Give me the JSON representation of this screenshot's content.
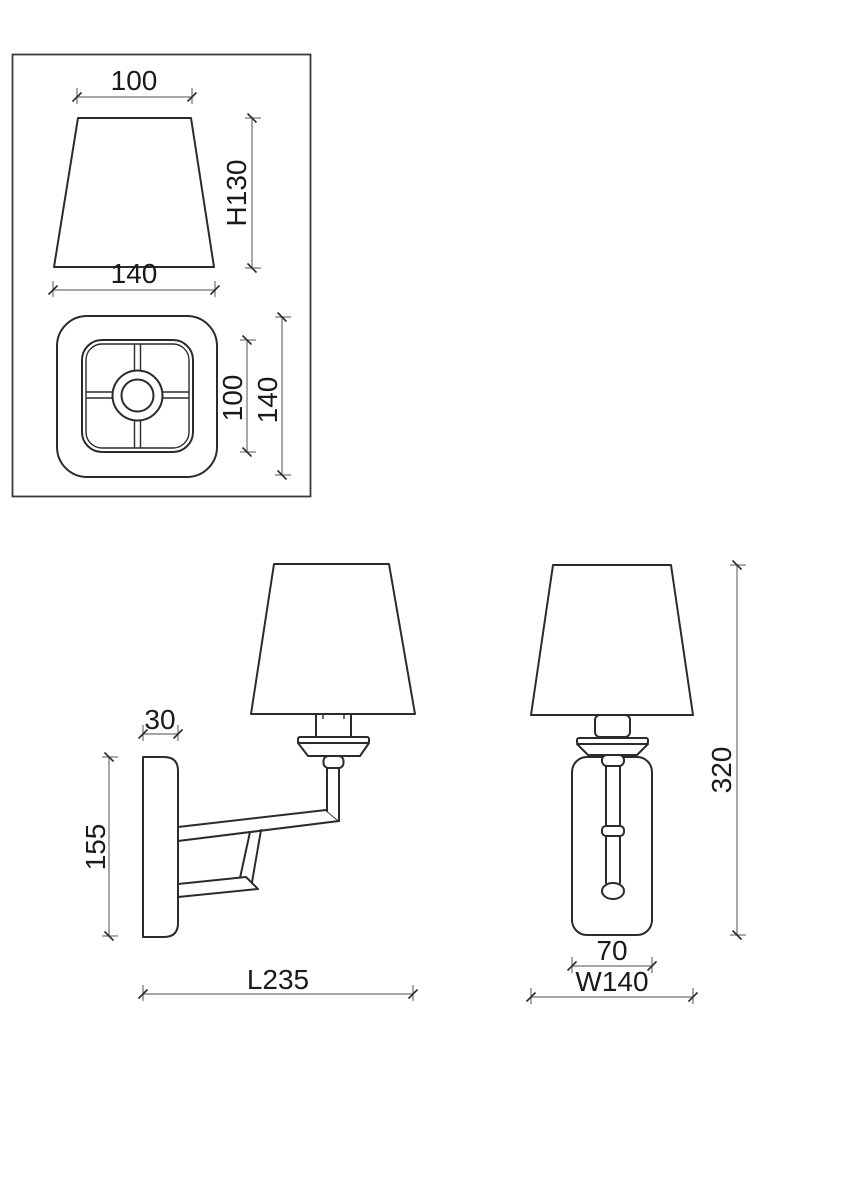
{
  "inset": {
    "shade_side_view": {
      "top_width_label": "100",
      "bottom_width_label": "140",
      "height_label": "H130"
    },
    "shade_top_view": {
      "inner_width_label": "100",
      "outer_width_label": "140"
    }
  },
  "side_view": {
    "plate_depth_label": "30",
    "plate_height_label": "155",
    "length_label": "L235"
  },
  "front_view": {
    "overall_height_label": "320",
    "plate_width_label": "70",
    "shade_width_label": "W140"
  },
  "colors": {
    "outline": "#2b2b2b",
    "dimension_line": "#707070",
    "label_text": "#1a1a1a",
    "background": "#ffffff"
  }
}
